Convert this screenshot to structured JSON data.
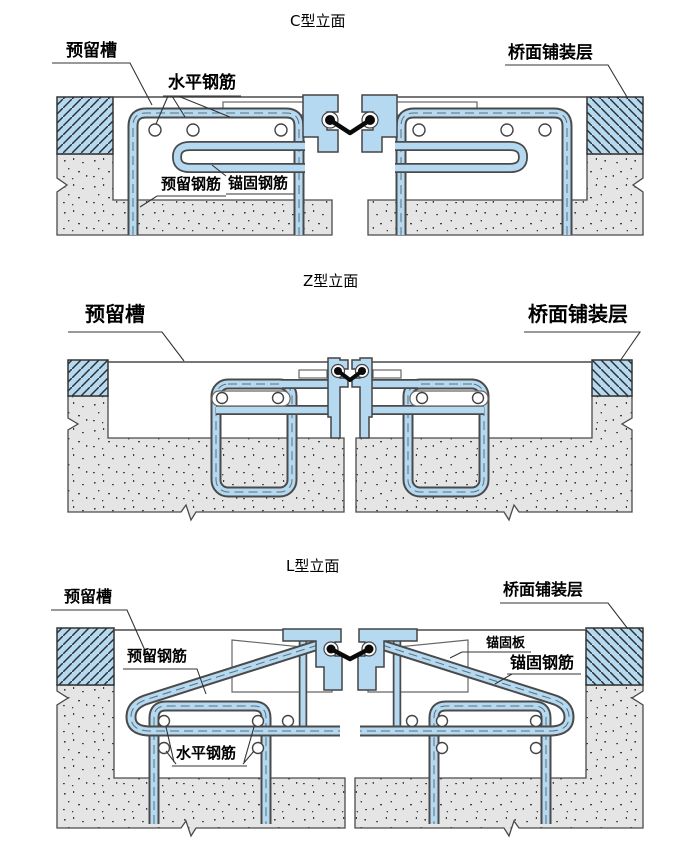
{
  "colors": {
    "steel_blue": "#b5d9f0",
    "outline": "#444444",
    "concrete_fill": "#e5e5e5",
    "pavement_hatch_blue": "#b5d9f0",
    "seal_black": "#0a0a0a",
    "background": "#ffffff"
  },
  "sections": [
    {
      "id": "c-type",
      "title": "C型立面",
      "labels": {
        "reserved_groove": "预留槽",
        "horizontal_rebar": "水平钢筋",
        "deck_pavement": "桥面铺装层",
        "reserved_rebar": "预留钢筋",
        "anchor_rebar": "锚固钢筋"
      }
    },
    {
      "id": "z-type",
      "title": "Z型立面",
      "labels": {
        "reserved_groove": "预留槽",
        "deck_pavement": "桥面铺装层"
      }
    },
    {
      "id": "l-type",
      "title": "L型立面",
      "labels": {
        "reserved_groove": "预留槽",
        "deck_pavement": "桥面铺装层",
        "reserved_rebar": "预留钢筋",
        "anchor_plate": "锚固板",
        "anchor_rebar": "锚固钢筋",
        "horizontal_rebar": "水平钢筋"
      }
    }
  ]
}
